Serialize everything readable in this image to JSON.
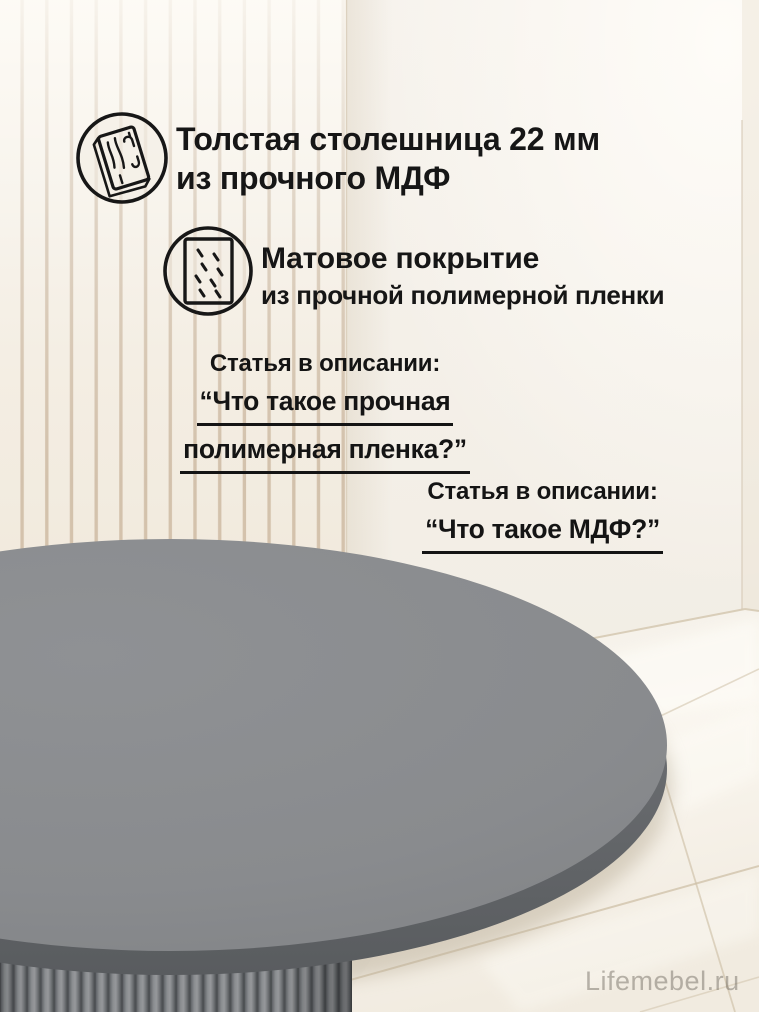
{
  "canvas": {
    "width": 759,
    "height": 1012
  },
  "colors": {
    "text": "#161616",
    "wall": "#f3efe8",
    "slat_line": "#b3977a",
    "floor": "#f7f3ec",
    "grout": "#cfc1a8",
    "table_top": "#8a8c8f",
    "table_edge": "#5f6265",
    "pedestal_rib": "#8b8e91",
    "watermark": "#8a8478"
  },
  "features": [
    {
      "icon": "mdf-board-icon",
      "title": "Толстая столешница 22 мм\nиз прочного МДФ"
    },
    {
      "icon": "matte-film-icon",
      "title": "Матовое покрытие",
      "subtitle": "из прочной полимерной пленки"
    }
  ],
  "articles": [
    {
      "label": "Статья в описании:",
      "quote_lines": [
        "“Что такое прочная",
        "полимерная пленка?”"
      ]
    },
    {
      "label": "Статья в описании:",
      "quote_lines": [
        "“Что такое МДФ?”"
      ]
    }
  ],
  "watermark": {
    "text": "Lifemebel.ru"
  }
}
